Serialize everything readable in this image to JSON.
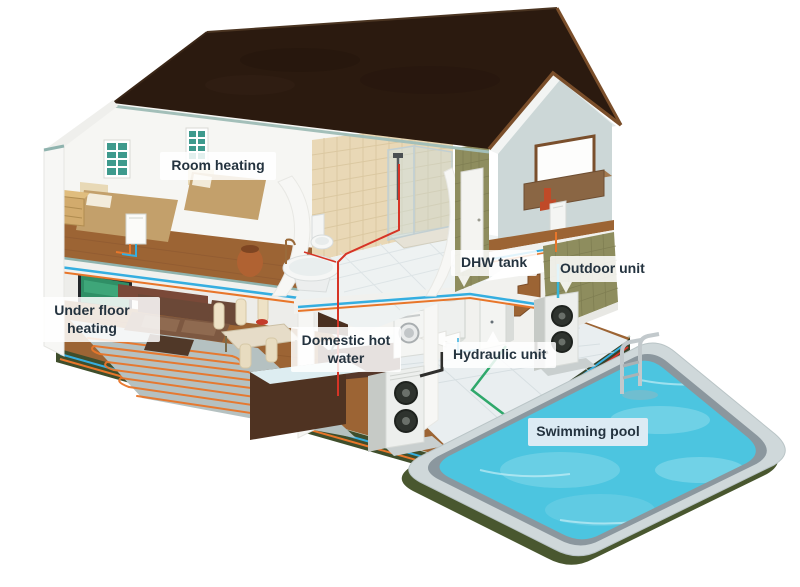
{
  "labels": {
    "room_heating": "Room heating",
    "under_floor_heating": "Under floor heating",
    "domestic_hot_water": "Domestic hot water",
    "dhw_tank": "DHW tank",
    "outdoor_unit": "Outdoor unit",
    "hydraulic_unit": "Hydraulic unit",
    "swimming_pool": "Swimming pool"
  },
  "colors": {
    "label_text": "#24333f",
    "pool_label_bg": "#dcebf4",
    "roof": "#2b1a0f",
    "gable": "#ccd7d7",
    "olive_tile": "#8e8d5e",
    "wood": "#9c6434",
    "tile_beige": "#e9d8b6",
    "screed": "#b5c1c1",
    "coil": "#e8762a",
    "pipe_red": "#d63426",
    "pipe_blue": "#35aee0",
    "pipe_orange": "#e8762a",
    "pipe_green": "#2fa86b",
    "pipe_cyan": "#35b6d9",
    "pool_water": "#4cc5e0",
    "pool_deck": "#cfd8da",
    "pool_rim": "#8b979e",
    "ground": "#3f4e2c",
    "unit_body": "#edefed",
    "window_teal": "#3e9a8d"
  }
}
